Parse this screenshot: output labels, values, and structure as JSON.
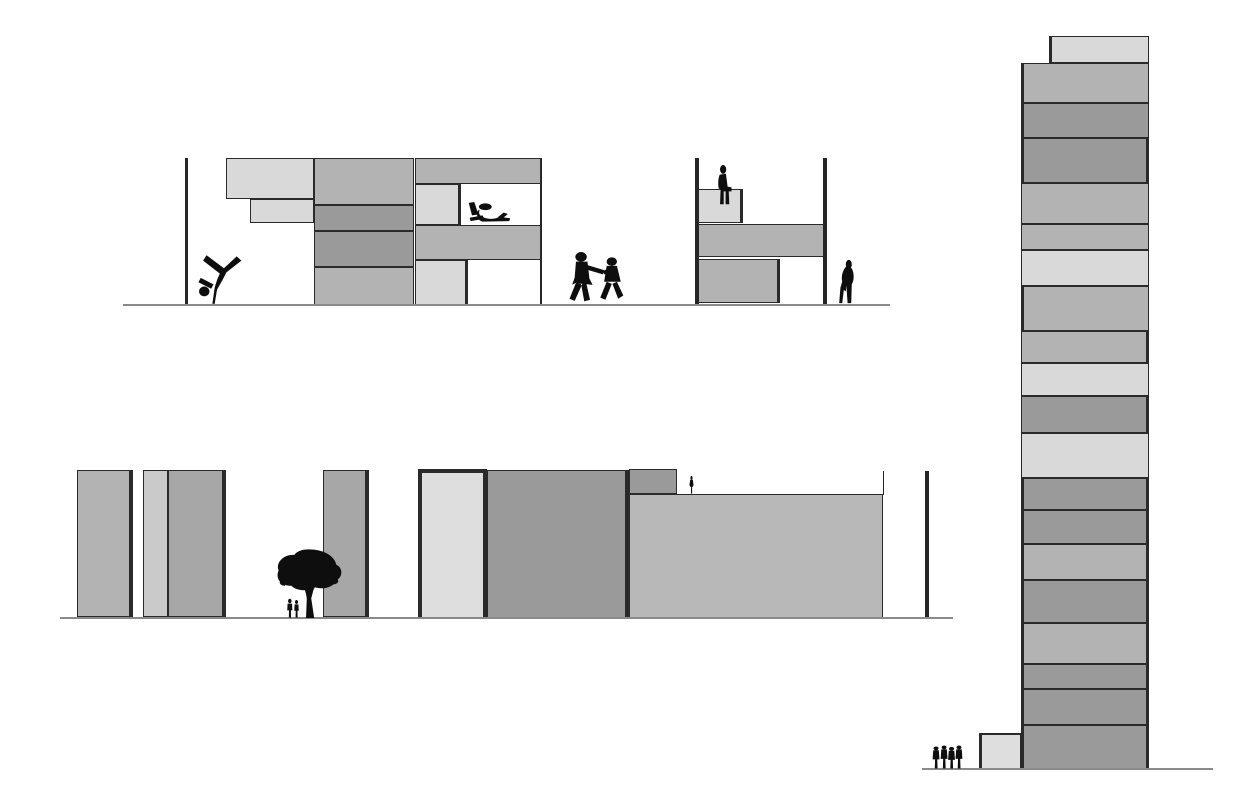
{
  "document": {
    "title": "Block stacking architectural elevations with figures",
    "visible_text": []
  },
  "palette": {
    "L": "#d9d9d9",
    "LL": "#dedede",
    "ML": "#cacaca",
    "M": "#b3b3b3",
    "BM": "#b8b8b8",
    "MD": "#a7a7a7",
    "D": "#9a9a9a",
    "ink": "#262626",
    "ground": "#8a8a8a",
    "figure": "#0e0e0e",
    "background": "#ffffff"
  },
  "scenes": {
    "top-elevation": {
      "ground": {
        "x1": 123,
        "x2": 890,
        "y": 304,
        "h": 2.2
      },
      "walls": [
        {
          "x": 186,
          "y1": 158,
          "y2": 305,
          "w": 3
        },
        {
          "x": 697,
          "y1": 158,
          "y2": 304,
          "w": 3.2
        },
        {
          "x": 825,
          "y1": 158,
          "y2": 304,
          "w": 3.2
        }
      ],
      "lines": [
        {
          "x": 540,
          "y": 158,
          "w": 2,
          "h": 147
        }
      ],
      "blocks": [
        {
          "x": 226,
          "y": 158,
          "w": 88,
          "h": 41,
          "f": "L"
        },
        {
          "x": 250,
          "y": 199,
          "w": 64,
          "h": 24,
          "f": "L"
        },
        {
          "x": 314,
          "y": 158,
          "w": 100,
          "h": 47,
          "f": "M"
        },
        {
          "x": 314,
          "y": 205,
          "w": 100,
          "h": 26,
          "f": "D"
        },
        {
          "x": 314,
          "y": 231,
          "w": 100,
          "h": 36,
          "f": "D"
        },
        {
          "x": 314,
          "y": 267,
          "w": 100,
          "h": 38,
          "f": "M"
        },
        {
          "x": 415,
          "y": 158,
          "w": 126,
          "h": 26,
          "f": "M"
        },
        {
          "x": 415,
          "y": 184,
          "w": 46,
          "h": 41,
          "f": "L",
          "b": {
            "r": 3
          }
        },
        {
          "x": 415,
          "y": 225,
          "w": 126,
          "h": 35,
          "f": "M"
        },
        {
          "x": 415,
          "y": 260,
          "w": 53,
          "h": 45,
          "f": "L",
          "b": {
            "r": 3
          }
        },
        {
          "x": 698,
          "y": 189,
          "w": 45,
          "h": 34,
          "f": "L",
          "b": {
            "r": 3
          }
        },
        {
          "x": 698,
          "y": 224,
          "w": 126,
          "h": 33,
          "f": "M"
        },
        {
          "x": 698,
          "y": 259,
          "w": 82,
          "h": 44,
          "f": "M",
          "b": {
            "r": 3
          }
        }
      ],
      "figures": [
        {
          "t": "cartwheel",
          "x": 188,
          "y": 252,
          "w": 58,
          "h": 54
        },
        {
          "t": "reading",
          "x": 466,
          "y": 201,
          "w": 46,
          "h": 24
        },
        {
          "t": "children",
          "x": 567,
          "y": 251,
          "w": 64,
          "h": 53
        },
        {
          "t": "sitting",
          "x": 708,
          "y": 165,
          "w": 28,
          "h": 40
        },
        {
          "t": "bending",
          "x": 832,
          "y": 259,
          "w": 30,
          "h": 45
        }
      ]
    },
    "bottom-elevation": {
      "ground": {
        "x1": 60,
        "x2": 953,
        "y": 616.5,
        "h": 2.2
      },
      "walls": [
        {
          "x": 927,
          "y1": 471,
          "y2": 618,
          "w": 3.5
        }
      ],
      "lines": [
        {
          "x": 882.5,
          "y": 471,
          "w": 1.8,
          "h": 24
        },
        {
          "x": 77,
          "y": 526,
          "w": 56,
          "h": 5
        },
        {
          "x": 168,
          "y": 502,
          "w": 56,
          "h": 1.8
        }
      ],
      "blocks": [
        {
          "x": 77,
          "y": 470,
          "w": 56,
          "h": 147,
          "f": "M",
          "b": {
            "r": 4
          }
        },
        {
          "x": 143,
          "y": 470,
          "w": 25,
          "h": 147,
          "f": "ML"
        },
        {
          "x": 168,
          "y": 470,
          "w": 58,
          "h": 147,
          "f": "MD",
          "b": {
            "r": 4
          }
        },
        {
          "x": 323,
          "y": 470,
          "w": 46,
          "h": 147,
          "f": "MD",
          "b": {
            "r": 4
          }
        },
        {
          "x": 418,
          "y": 469,
          "w": 69,
          "h": 149,
          "f": "LL",
          "b": {
            "t": 4,
            "l": 4,
            "r": 4
          }
        },
        {
          "x": 487,
          "y": 470,
          "w": 142,
          "h": 148,
          "f": "D",
          "b": {
            "r": 4.5
          }
        },
        {
          "x": 629,
          "y": 469,
          "w": 48,
          "h": 25,
          "f": "D"
        },
        {
          "x": 629,
          "y": 494,
          "w": 254,
          "h": 124,
          "f": "BM"
        }
      ],
      "figures": [
        {
          "t": "tree",
          "x": 272,
          "y": 548,
          "w": 74,
          "h": 70
        },
        {
          "t": "pair",
          "x": 285,
          "y": 598,
          "w": 16,
          "h": 20
        },
        {
          "t": "standing",
          "x": 686,
          "y": 476,
          "w": 11,
          "h": 18
        }
      ]
    },
    "tower-elevation": {
      "ground": {
        "x1": 922,
        "x2": 1213,
        "y": 768.3,
        "h": 2.2
      },
      "walls": [],
      "lines": [],
      "blocks": [
        {
          "x": 1049,
          "y": 36,
          "w": 100,
          "h": 27,
          "f": "L",
          "b": {
            "l": 3
          }
        },
        {
          "x": 1021,
          "y": 63,
          "w": 128,
          "h": 40,
          "f": "M",
          "b": {
            "l": 3
          }
        },
        {
          "x": 1021,
          "y": 103,
          "w": 128,
          "h": 35,
          "f": "D",
          "b": {
            "l": 3
          }
        },
        {
          "x": 1021,
          "y": 138,
          "w": 128,
          "h": 45,
          "f": "D",
          "b": {
            "l": 3,
            "r": 3.5
          }
        },
        {
          "x": 1021,
          "y": 183,
          "w": 128,
          "h": 41,
          "f": "M"
        },
        {
          "x": 1021,
          "y": 224,
          "w": 128,
          "h": 26,
          "f": "M"
        },
        {
          "x": 1021,
          "y": 250,
          "w": 128,
          "h": 36,
          "f": "L"
        },
        {
          "x": 1021,
          "y": 286,
          "w": 128,
          "h": 45,
          "f": "M",
          "b": {
            "l": 3
          }
        },
        {
          "x": 1021,
          "y": 331,
          "w": 128,
          "h": 32,
          "f": "M",
          "b": {
            "r": 3.5
          }
        },
        {
          "x": 1021,
          "y": 363,
          "w": 128,
          "h": 33,
          "f": "L"
        },
        {
          "x": 1021,
          "y": 396,
          "w": 128,
          "h": 37,
          "f": "D",
          "b": {
            "r": 3
          }
        },
        {
          "x": 1021,
          "y": 433,
          "w": 128,
          "h": 45,
          "f": "L"
        },
        {
          "x": 1021,
          "y": 478,
          "w": 128,
          "h": 32,
          "f": "D",
          "b": {
            "l": 3,
            "r": 3
          }
        },
        {
          "x": 1021,
          "y": 510,
          "w": 128,
          "h": 34,
          "f": "D",
          "b": {
            "l": 3,
            "r": 3
          }
        },
        {
          "x": 1021,
          "y": 544,
          "w": 128,
          "h": 36,
          "f": "M",
          "b": {
            "l": 3,
            "r": 3
          }
        },
        {
          "x": 1021,
          "y": 580,
          "w": 128,
          "h": 43,
          "f": "D",
          "b": {
            "l": 3,
            "r": 3
          }
        },
        {
          "x": 1021,
          "y": 623,
          "w": 128,
          "h": 41,
          "f": "M",
          "b": {
            "l": 3,
            "r": 3
          }
        },
        {
          "x": 1021,
          "y": 664,
          "w": 128,
          "h": 25,
          "f": "D",
          "b": {
            "l": 3,
            "r": 3
          }
        },
        {
          "x": 1021,
          "y": 689,
          "w": 128,
          "h": 36,
          "f": "D",
          "b": {
            "l": 3,
            "r": 3
          }
        },
        {
          "x": 1021,
          "y": 725,
          "w": 128,
          "h": 44,
          "f": "D",
          "b": {
            "l": 3,
            "r": 3
          }
        },
        {
          "x": 979,
          "y": 733,
          "w": 42,
          "h": 36,
          "f": "LL",
          "b": {
            "l": 3.5,
            "t": 2
          }
        }
      ],
      "figures": [
        {
          "t": "group",
          "x": 932,
          "y": 745,
          "w": 31,
          "h": 24
        }
      ]
    }
  }
}
